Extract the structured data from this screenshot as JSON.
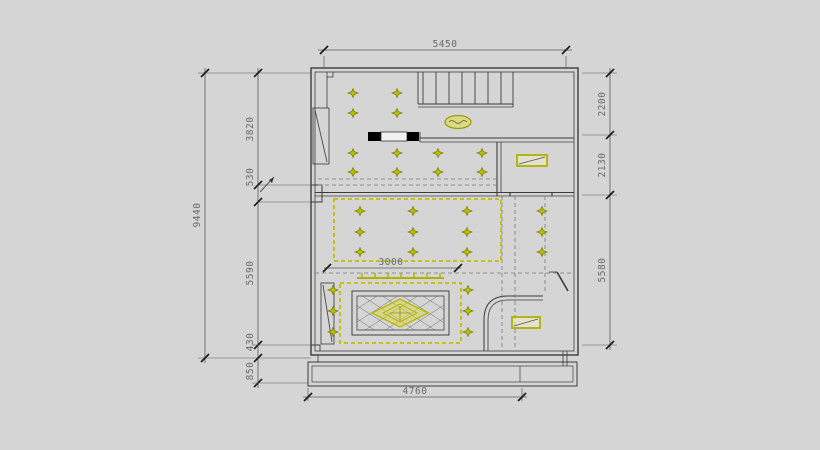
{
  "drawing": {
    "type": "ceiling-lighting-plan",
    "colors": {
      "background": "#d5d5d5",
      "wall_line": "#3c3c3c",
      "dim_line": "#5a5a5a",
      "dim_text": "#6a6a6a",
      "fixture_yellow": "#b9b900",
      "spotlight_fill": "#b2c400",
      "header_black": "#000000"
    },
    "dimensions": {
      "top_width": "5450",
      "bottom_width": "4760",
      "inner_width": "3000",
      "left_total": "9440",
      "left_chain": [
        "3820",
        "530",
        "5590",
        "430",
        "850"
      ],
      "right_chain": [
        "2200",
        "2130",
        "5580"
      ]
    }
  }
}
